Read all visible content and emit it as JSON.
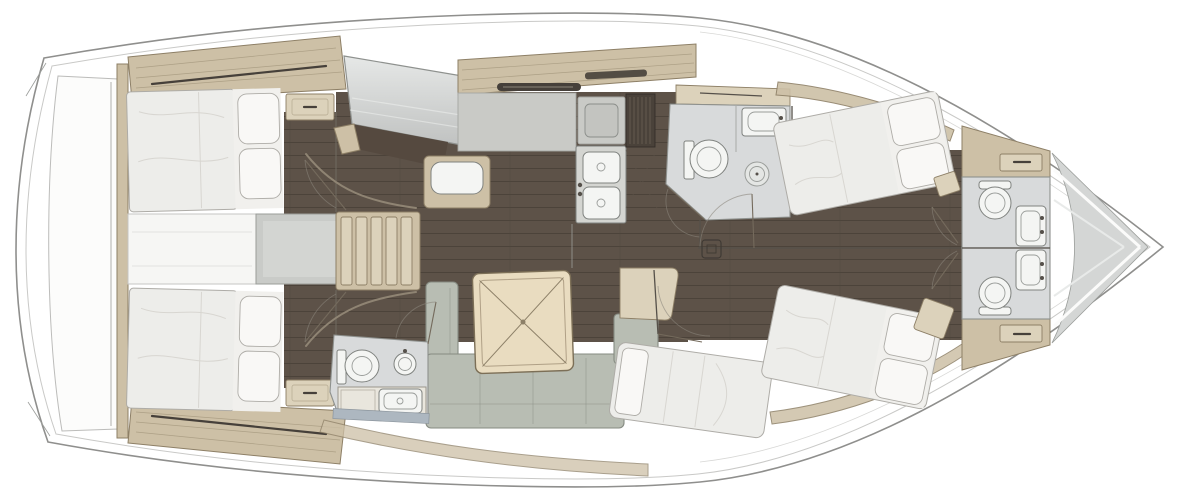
{
  "meta": {
    "type": "diagram",
    "subtype": "yacht-interior-floor-plan",
    "orientation": "bow-right"
  },
  "colors": {
    "hull_line": "#8f8f8d",
    "hull_inner": "#c9c9c7",
    "platform": "#fcfcfb",
    "wood": "#cdc0a6",
    "wood_light": "#dcd2bb",
    "wood_edge": "#8d7f66",
    "floor_base": "#5d5248",
    "floor_line": "#4c433a",
    "floor_edge": "#3e3933",
    "bath": "#d8dadb",
    "counter": "#c9cac6",
    "fixture": "#f4f5f3",
    "fixture_edge": "#7f827f",
    "sofa": "#b8bdb3",
    "sofa_edge": "#868b82",
    "table": "#e9dcc0",
    "table_edge": "#7c6f57",
    "bed": "#ededea",
    "bed_edge": "#aeaca7",
    "bed_shadow": "#d8d6d1",
    "pillow": "#f9f8f6",
    "wall": "#8e918e",
    "wall_dark": "#56514a",
    "dark_fitting": "#46403a",
    "accent_strip": "#adb7c0",
    "arc": "#8b857b",
    "engine_box": "#c9cbc8",
    "hatch_white": "#f6f6f4"
  },
  "areas": {
    "transom": {
      "name": "Transom swim platform"
    },
    "aft_cabin_port": {
      "name": "Aft cabin port - double berth"
    },
    "aft_cabin_starboard": {
      "name": "Aft cabin starboard - double berth"
    },
    "engine_compartment": {
      "name": "Engine compartment"
    },
    "companionway": {
      "name": "Companionway steps",
      "step_count": 5
    },
    "nav_station": {
      "name": "Navigation station with chart table"
    },
    "galley": {
      "name": "Galley - stove, double sink, fridge"
    },
    "salon": {
      "name": "Salon - U-shaped sofa and square table"
    },
    "settee_berth": {
      "name": "Starboard settee berth"
    },
    "aft_head": {
      "name": "Aft head - toilet, basin, vanity"
    },
    "forward_head_port": {
      "name": "Forward head port - toilet, basin, shower"
    },
    "forward_cabin_port": {
      "name": "Forward cabin port - double berth"
    },
    "forward_cabin_starboard": {
      "name": "Forward cabin starboard - double berth"
    },
    "bow_head_port": {
      "name": "Bow head port - toilet and basin"
    },
    "bow_head_starboard": {
      "name": "Bow head starboard - toilet and basin"
    },
    "bow_locker": {
      "name": "Bow locker forepeak"
    }
  },
  "fixtures": {
    "berths": 5,
    "toilets": 4,
    "basins": 5,
    "galley_sink_bowls": 2,
    "companionway_steps": 5,
    "dining_tables": 1
  }
}
